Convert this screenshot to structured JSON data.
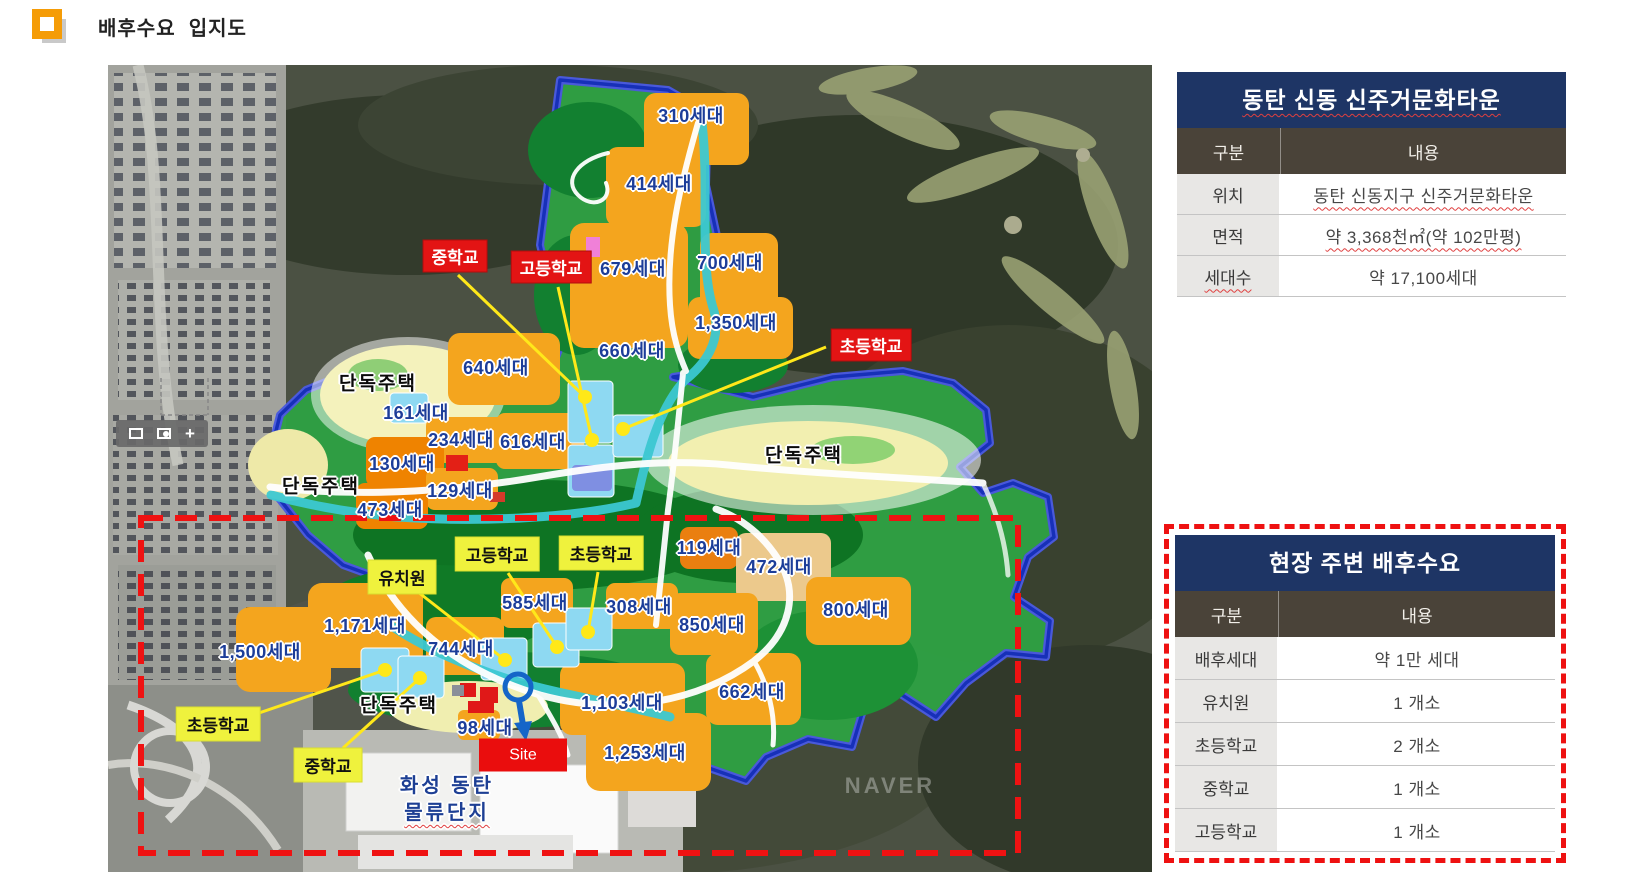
{
  "page": {
    "title": "배후수요  입지도"
  },
  "colors": {
    "accent_navy": "#1e3565",
    "header_brown": "#4a4339",
    "tag_red": "#e31414",
    "tag_yellow": "#eff23d",
    "dashed_red": "#ee1111",
    "unit_label_blue": "#1c3d99",
    "site_red": "#ea0d0d",
    "parcel_orange": "#f4a51e",
    "zone_green": "#2fa043",
    "boundary_blue": "#1730b8",
    "river_teal": "#3cc8d2"
  },
  "map": {
    "watermark": "NAVER",
    "site_label": "Site",
    "logistics_line1": "화성 동탄",
    "logistics_line2": "물류단지",
    "toolbar_plus": "+",
    "unit_labels": [
      {
        "text": "310세대",
        "x": 583,
        "y": 50
      },
      {
        "text": "414세대",
        "x": 551,
        "y": 118
      },
      {
        "text": "679세대",
        "x": 525,
        "y": 203
      },
      {
        "text": "700세대",
        "x": 622,
        "y": 197
      },
      {
        "text": "1,350세대",
        "x": 628,
        "y": 257
      },
      {
        "text": "660세대",
        "x": 524,
        "y": 285
      },
      {
        "text": "640세대",
        "x": 388,
        "y": 302
      },
      {
        "text": "161세대",
        "x": 308,
        "y": 347
      },
      {
        "text": "234세대",
        "x": 353,
        "y": 374
      },
      {
        "text": "616세대",
        "x": 425,
        "y": 376
      },
      {
        "text": "130세대",
        "x": 294,
        "y": 398
      },
      {
        "text": "129세대",
        "x": 352,
        "y": 425
      },
      {
        "text": "473세대",
        "x": 282,
        "y": 444
      },
      {
        "text": "119세대",
        "x": 601,
        "y": 482
      },
      {
        "text": "472세대",
        "x": 671,
        "y": 501
      },
      {
        "text": "585세대",
        "x": 427,
        "y": 537
      },
      {
        "text": "308세대",
        "x": 531,
        "y": 541
      },
      {
        "text": "800세대",
        "x": 748,
        "y": 544
      },
      {
        "text": "850세대",
        "x": 604,
        "y": 559
      },
      {
        "text": "1,171세대",
        "x": 257,
        "y": 560
      },
      {
        "text": "1,500세대",
        "x": 152,
        "y": 586
      },
      {
        "text": "744세대",
        "x": 353,
        "y": 583
      },
      {
        "text": "662세대",
        "x": 644,
        "y": 626
      },
      {
        "text": "1,103세대",
        "x": 514,
        "y": 637
      },
      {
        "text": "98세대",
        "x": 377,
        "y": 662
      },
      {
        "text": "1,253세대",
        "x": 537,
        "y": 687
      }
    ],
    "red_tags": [
      {
        "text": "중학교",
        "x": 347,
        "y": 191
      },
      {
        "text": "고등학교",
        "x": 443,
        "y": 202
      },
      {
        "text": "초등학교",
        "x": 763,
        "y": 280
      }
    ],
    "yellow_tags": [
      {
        "text": "고등학교",
        "x": 389,
        "y": 489
      },
      {
        "text": "초등학교",
        "x": 493,
        "y": 488
      },
      {
        "text": "유치원",
        "x": 294,
        "y": 512
      },
      {
        "text": "초등학교",
        "x": 110,
        "y": 659
      },
      {
        "text": "중학교",
        "x": 220,
        "y": 700
      }
    ],
    "housing_labels": [
      {
        "text": "단독주택",
        "x": 270,
        "y": 317
      },
      {
        "text": "단독주택",
        "x": 213,
        "y": 420
      },
      {
        "text": "단독주택",
        "x": 696,
        "y": 389
      },
      {
        "text": "단독주택",
        "x": 291,
        "y": 639
      }
    ]
  },
  "table_top": {
    "title": "동탄 신동 신주거문화타운",
    "col1": "구분",
    "col2": "내용",
    "rows": [
      {
        "label": "위치",
        "value": "동탄 신동지구 신주거문화타운",
        "value_wavy": true
      },
      {
        "label": "면적",
        "value": "약 3,368천㎡(약 102만평)",
        "value_wavy": true
      },
      {
        "label": "세대수",
        "value": "약 17,100세대",
        "label_wavy": true
      }
    ]
  },
  "table_bottom": {
    "title": "현장 주변 배후수요",
    "col1": "구분",
    "col2": "내용",
    "rows": [
      {
        "label": "배후세대",
        "value": "약 1만 세대"
      },
      {
        "label": "유치원",
        "value": "1 개소"
      },
      {
        "label": "초등학교",
        "value": "2 개소"
      },
      {
        "label": "중학교",
        "value": "1 개소"
      },
      {
        "label": "고등학교",
        "value": "1 개소"
      }
    ]
  }
}
